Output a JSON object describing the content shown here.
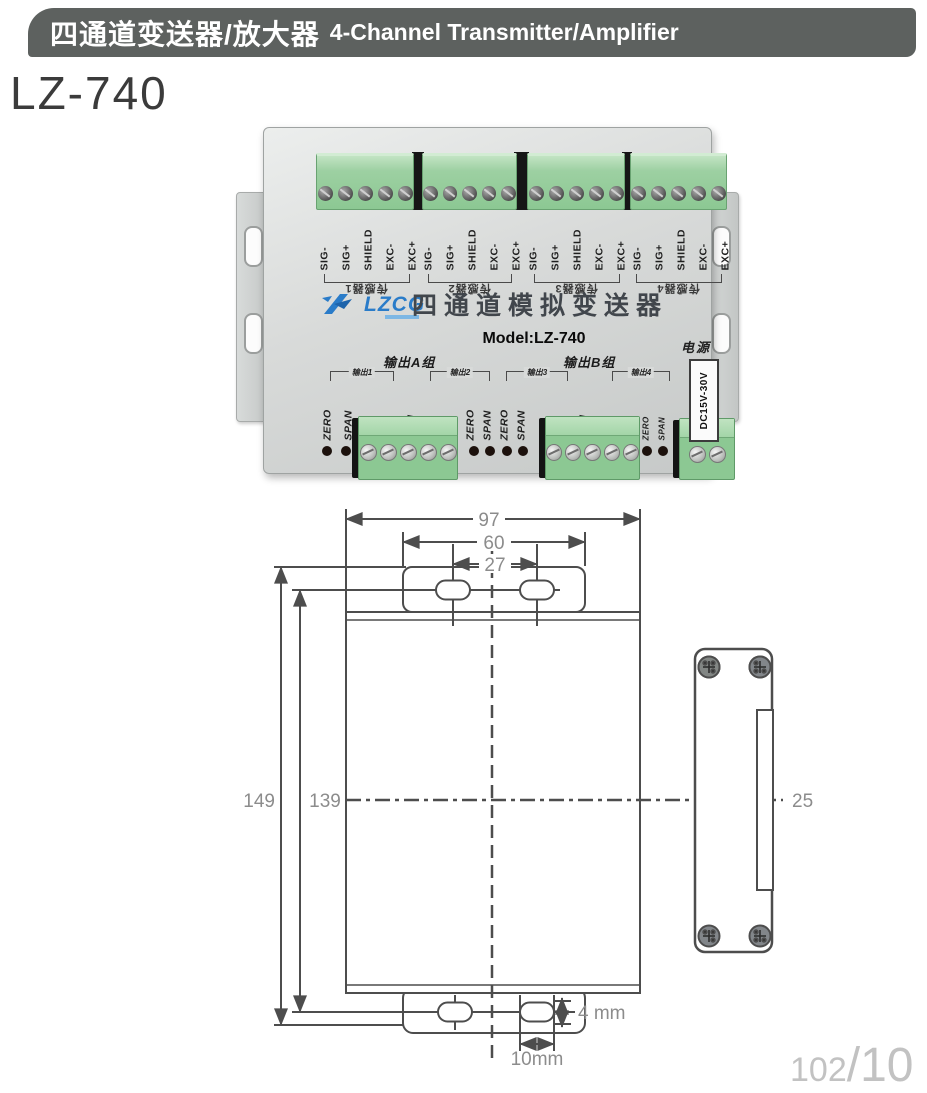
{
  "header": {
    "title_zh": "四通道变送器/放大器",
    "title_en": "4-Channel Transmitter/Amplifier"
  },
  "product": {
    "model": "LZ-740"
  },
  "device": {
    "brand": "LZCG",
    "panel_title": "四通道模拟变送器",
    "model_line": "Model:LZ-740",
    "sensor_pins": [
      "SIG-",
      "SIG+",
      "SHIELD",
      "EXC-",
      "EXC+"
    ],
    "sensor_groups": [
      "传感器1",
      "传感器2",
      "传感器3",
      "传感器4"
    ],
    "output_group_a": "输出A组",
    "output_group_b": "输出B组",
    "output_brackets": [
      "输出1",
      "输出2",
      "输出3",
      "输出4"
    ],
    "pins_a": [
      "ZERO",
      "SPAN",
      "V",
      "I",
      "COM",
      "V",
      "I",
      "ZERO",
      "SPAN"
    ],
    "pins_b": [
      "ZERO",
      "SPAN",
      "V",
      "I",
      "COM",
      "V",
      "I"
    ],
    "adjust_pins": [
      "ZERO",
      "SPAN"
    ],
    "power_label": "电源",
    "power_rating": "DC15V-30V"
  },
  "drawing": {
    "dim_width": "97",
    "dim_tab": "60",
    "dim_slots": "27",
    "dim_height": "149",
    "dim_holes": "139",
    "dim_side": "25",
    "dim_slot_h": "4 mm",
    "dim_slot_w": "10mm"
  },
  "footer": {
    "page_left": "102",
    "page_right": "/10"
  },
  "colors": {
    "header_bg": "#5d615f",
    "accent_blue": "#2a7cc9",
    "terminal_green": "#8cc893"
  }
}
